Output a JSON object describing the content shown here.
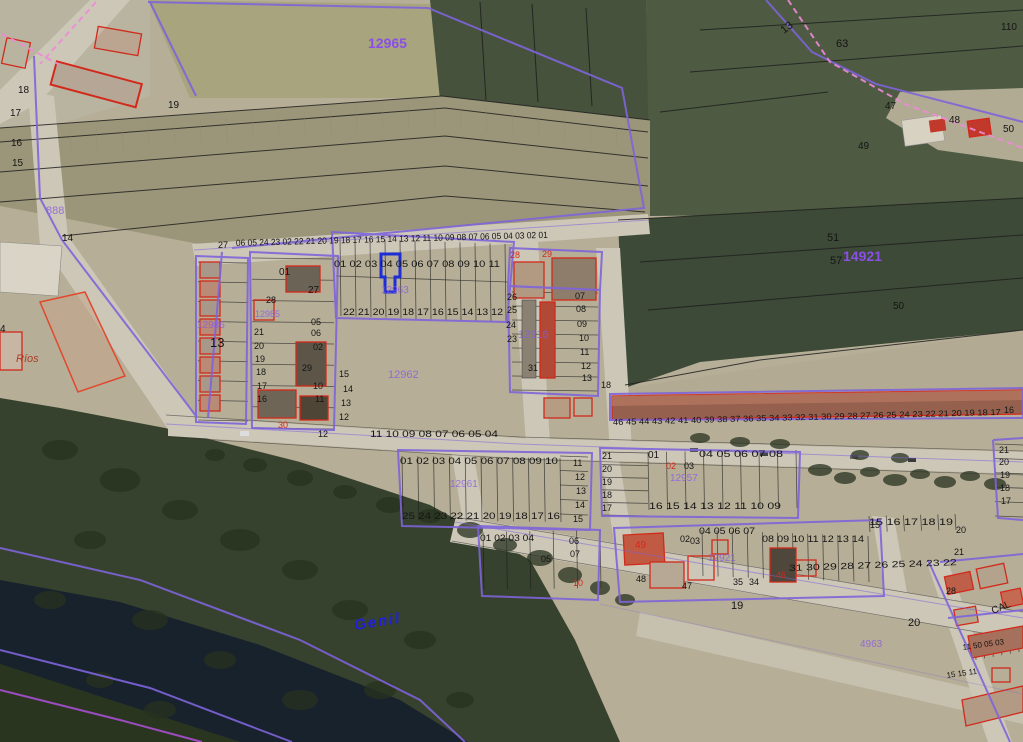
{
  "map": {
    "type": "cadastral-aerial-view",
    "selected_parcel": {
      "number": "04"
    },
    "colors": {
      "black": "#151515",
      "zone": "#8a4fe8",
      "zoneFaint": "#8a5ce0",
      "red": "#d3291b",
      "river": "#2020dd",
      "darkred": "#b33a28",
      "boundary": "#7e64da",
      "selected": "#1d2ed6",
      "dashed": "#ef8ad9"
    },
    "labels": [
      {
        "t": "12965",
        "x": 368,
        "y": 48,
        "s": 14,
        "c": "zone",
        "b": true,
        "n": "zone-code-label"
      },
      {
        "t": "14921",
        "x": 843,
        "y": 261,
        "s": 14,
        "c": "zone",
        "b": true,
        "n": "zone-code-label"
      },
      {
        "t": "12963",
        "x": 381,
        "y": 293,
        "s": 10,
        "c": "zoneFaint",
        "n": "zone-code-label"
      },
      {
        "t": "12962",
        "x": 388,
        "y": 378,
        "s": 11,
        "c": "zoneFaint",
        "n": "zone-code-label"
      },
      {
        "t": "12916",
        "x": 518,
        "y": 338,
        "s": 11,
        "c": "zoneFaint",
        "n": "zone-code-label"
      },
      {
        "t": "12986",
        "x": 197,
        "y": 328,
        "s": 10,
        "c": "zoneFaint",
        "n": "zone-code-label"
      },
      {
        "t": "12985",
        "x": 255,
        "y": 317,
        "s": 9,
        "c": "zoneFaint",
        "n": "zone-code-label"
      },
      {
        "t": "12961",
        "x": 450,
        "y": 487,
        "s": 10,
        "c": "zoneFaint",
        "n": "zone-code-label"
      },
      {
        "t": "12957",
        "x": 670,
        "y": 481,
        "s": 10,
        "c": "zoneFaint",
        "n": "zone-code-label"
      },
      {
        "t": "12921",
        "x": 708,
        "y": 561,
        "s": 10,
        "c": "zoneFaint",
        "n": "zone-code-label"
      },
      {
        "t": "888",
        "x": 46,
        "y": 214,
        "s": 11,
        "c": "zoneFaint",
        "n": "zone-code-label"
      },
      {
        "t": "4963",
        "x": 860,
        "y": 647,
        "s": 10,
        "c": "zoneFaint",
        "n": "zone-code-label"
      },
      {
        "t": "Genil",
        "x": 355,
        "y": 630,
        "s": 15,
        "c": "river",
        "b": true,
        "i": true,
        "r": -9,
        "n": "river-name-label"
      },
      {
        "t": "CAL",
        "x": 993,
        "y": 614,
        "s": 10,
        "r": -22,
        "n": "street-name-label"
      },
      {
        "t": "Ríos",
        "x": 16,
        "y": 362,
        "s": 11,
        "c": "darkred",
        "i": true,
        "n": "place-name-label"
      },
      {
        "t": "18",
        "x": 18,
        "y": 93,
        "s": 10
      },
      {
        "t": "19",
        "x": 168,
        "y": 108,
        "s": 10
      },
      {
        "t": "17",
        "x": 10,
        "y": 116,
        "s": 10
      },
      {
        "t": "16",
        "x": 11,
        "y": 146,
        "s": 10
      },
      {
        "t": "15",
        "x": 12,
        "y": 166,
        "s": 10
      },
      {
        "t": "14",
        "x": 62,
        "y": 241,
        "s": 10
      },
      {
        "t": "4",
        "x": 0,
        "y": 332,
        "s": 10
      },
      {
        "t": "13",
        "x": 784,
        "y": 34,
        "s": 11,
        "r": -38
      },
      {
        "t": "63",
        "x": 836,
        "y": 47,
        "s": 11
      },
      {
        "t": "110",
        "x": 1001,
        "y": 30,
        "s": 10
      },
      {
        "t": "47",
        "x": 885,
        "y": 109,
        "s": 10
      },
      {
        "t": "49",
        "x": 858,
        "y": 149,
        "s": 10
      },
      {
        "t": "48",
        "x": 949,
        "y": 123,
        "s": 10
      },
      {
        "t": "50",
        "x": 1003,
        "y": 132,
        "s": 10
      },
      {
        "t": "51",
        "x": 827,
        "y": 241,
        "s": 11
      },
      {
        "t": "57",
        "x": 830,
        "y": 264,
        "s": 11
      },
      {
        "t": "50",
        "x": 893,
        "y": 309,
        "s": 10
      },
      {
        "t": "27",
        "x": 218,
        "y": 248
      },
      {
        "t": "01",
        "x": 279,
        "y": 275,
        "s": 10
      },
      {
        "t": "27",
        "x": 308,
        "y": 293,
        "s": 10
      },
      {
        "t": "28",
        "x": 266,
        "y": 303
      },
      {
        "t": "13",
        "x": 210,
        "y": 347,
        "s": 13
      },
      {
        "t": "05",
        "x": 311,
        "y": 325
      },
      {
        "t": "06",
        "x": 311,
        "y": 336
      },
      {
        "t": "02",
        "x": 313,
        "y": 350
      },
      {
        "t": "21",
        "x": 254,
        "y": 335
      },
      {
        "t": "20",
        "x": 254,
        "y": 349
      },
      {
        "t": "19",
        "x": 255,
        "y": 362
      },
      {
        "t": "18",
        "x": 256,
        "y": 375
      },
      {
        "t": "17",
        "x": 257,
        "y": 389
      },
      {
        "t": "16",
        "x": 257,
        "y": 402
      },
      {
        "t": "29",
        "x": 302,
        "y": 371
      },
      {
        "t": "10",
        "x": 313,
        "y": 389
      },
      {
        "t": "11",
        "x": 315,
        "y": 402
      },
      {
        "t": "30",
        "x": 278,
        "y": 428,
        "c": "red"
      },
      {
        "t": "12",
        "x": 318,
        "y": 437
      },
      {
        "t": "15",
        "x": 339,
        "y": 377
      },
      {
        "t": "14",
        "x": 343,
        "y": 392
      },
      {
        "t": "13",
        "x": 341,
        "y": 406
      },
      {
        "t": "12",
        "x": 339,
        "y": 420
      },
      {
        "t": "28",
        "x": 510,
        "y": 258,
        "c": "red"
      },
      {
        "t": "29",
        "x": 542,
        "y": 257,
        "c": "red"
      },
      {
        "t": "26",
        "x": 507,
        "y": 300
      },
      {
        "t": "25",
        "x": 507,
        "y": 313
      },
      {
        "t": "24",
        "x": 506,
        "y": 328
      },
      {
        "t": "23",
        "x": 507,
        "y": 342
      },
      {
        "t": "07",
        "x": 575,
        "y": 299
      },
      {
        "t": "08",
        "x": 576,
        "y": 312
      },
      {
        "t": "09",
        "x": 577,
        "y": 327
      },
      {
        "t": "10",
        "x": 579,
        "y": 341
      },
      {
        "t": "11",
        "x": 580,
        "y": 355
      },
      {
        "t": "12",
        "x": 581,
        "y": 369
      },
      {
        "t": "13",
        "x": 582,
        "y": 381
      },
      {
        "t": "31",
        "x": 528,
        "y": 371
      },
      {
        "t": "18",
        "x": 601,
        "y": 388
      },
      {
        "t": "16",
        "x": 1004,
        "y": 413
      },
      {
        "t": "21",
        "x": 999,
        "y": 453
      },
      {
        "t": "20",
        "x": 999,
        "y": 465
      },
      {
        "t": "19",
        "x": 1000,
        "y": 478
      },
      {
        "t": "18",
        "x": 1000,
        "y": 491
      },
      {
        "t": "17",
        "x": 1001,
        "y": 504
      },
      {
        "t": "11",
        "x": 573,
        "y": 466
      },
      {
        "t": "12",
        "x": 575,
        "y": 480
      },
      {
        "t": "13",
        "x": 576,
        "y": 494
      },
      {
        "t": "14",
        "x": 575,
        "y": 508
      },
      {
        "t": "15",
        "x": 573,
        "y": 522
      },
      {
        "t": "21",
        "x": 602,
        "y": 459
      },
      {
        "t": "20",
        "x": 602,
        "y": 472
      },
      {
        "t": "19",
        "x": 602,
        "y": 485
      },
      {
        "t": "18",
        "x": 602,
        "y": 498
      },
      {
        "t": "17",
        "x": 602,
        "y": 511
      },
      {
        "t": "01",
        "x": 648,
        "y": 458,
        "s": 10
      },
      {
        "t": "02",
        "x": 666,
        "y": 469,
        "c": "red"
      },
      {
        "t": "03",
        "x": 684,
        "y": 469
      },
      {
        "t": "05",
        "x": 541,
        "y": 562
      },
      {
        "t": "06",
        "x": 569,
        "y": 544
      },
      {
        "t": "07",
        "x": 570,
        "y": 557
      },
      {
        "t": "10",
        "x": 573,
        "y": 586,
        "c": "red"
      },
      {
        "t": "49",
        "x": 635,
        "y": 548,
        "s": 10,
        "c": "red"
      },
      {
        "t": "48",
        "x": 636,
        "y": 582
      },
      {
        "t": "02",
        "x": 680,
        "y": 542
      },
      {
        "t": "03",
        "x": 690,
        "y": 544
      },
      {
        "t": "15",
        "x": 870,
        "y": 528
      },
      {
        "t": "20",
        "x": 956,
        "y": 533
      },
      {
        "t": "21",
        "x": 954,
        "y": 555
      },
      {
        "t": "47",
        "x": 682,
        "y": 589
      },
      {
        "t": "35",
        "x": 733,
        "y": 585
      },
      {
        "t": "34",
        "x": 749,
        "y": 585
      },
      {
        "t": "46",
        "x": 776,
        "y": 578,
        "c": "red"
      },
      {
        "t": "19",
        "x": 731,
        "y": 609,
        "s": 11
      },
      {
        "t": "20",
        "x": 908,
        "y": 626,
        "s": 11
      },
      {
        "t": "28",
        "x": 946,
        "y": 594
      },
      {
        "t": "06 05 24 23 02 22 21 20 19 18 17 16 15 14 13 12 11 10 09 08 07 06 05 04 03 02 01",
        "x": 236,
        "y": 246,
        "l": 312,
        "r": -1.5,
        "n": "parcel-number-row"
      },
      {
        "t": "01 02 03 04 05 06 07 08 09 10 11",
        "x": 334,
        "y": 267,
        "l": 166,
        "n": "parcel-number-row"
      },
      {
        "t": "22 21 20 19 18 17 16 15 14 13 12",
        "x": 343,
        "y": 315,
        "l": 160,
        "n": "parcel-number-row"
      },
      {
        "t": "11 10 09 08 07 06 05 04",
        "x": 370,
        "y": 437,
        "l": 128,
        "n": "parcel-number-row"
      },
      {
        "t": "46 45 44 43 42 41 40 39 38 37 36 35 34 33 32 31 30 29 28 27 26 25 24 23 22 21 20 19 18 17",
        "x": 613,
        "y": 425,
        "s": 8.5,
        "l": 388,
        "r": -1.5,
        "n": "parcel-number-row"
      },
      {
        "t": "01 02 03 04 05 06 07 08 09 10",
        "x": 400,
        "y": 464,
        "l": 158,
        "n": "parcel-number-row"
      },
      {
        "t": "25 24 23 22 21 20 19 18 17 16",
        "x": 402,
        "y": 519,
        "l": 158,
        "n": "parcel-number-row"
      },
      {
        "t": "04 05 06 07 08",
        "x": 699,
        "y": 457,
        "l": 84,
        "n": "parcel-number-row"
      },
      {
        "t": "16 15 14 13 12 11 10 09",
        "x": 649,
        "y": 509,
        "l": 132,
        "n": "parcel-number-row"
      },
      {
        "t": "01 02 03 04",
        "x": 480,
        "y": 541,
        "l": 54,
        "n": "parcel-number-row"
      },
      {
        "t": "04 05 06 07",
        "x": 699,
        "y": 534,
        "l": 56,
        "n": "parcel-number-row"
      },
      {
        "t": "08 09 10 11 12 13 14",
        "x": 762,
        "y": 542,
        "l": 102,
        "n": "parcel-number-row"
      },
      {
        "t": "15 16 17 18 19",
        "x": 869,
        "y": 525,
        "l": 84,
        "n": "parcel-number-row"
      },
      {
        "t": "31 30 29 28 27 26 25 24 23 22",
        "x": 789,
        "y": 571,
        "l": 168,
        "r": -2,
        "n": "parcel-number-row"
      },
      {
        "t": "11 50 05 03",
        "x": 963,
        "y": 650,
        "s": 8,
        "r": -8,
        "n": "parcel-number-row"
      },
      {
        "t": "15 15 11",
        "x": 947,
        "y": 678,
        "s": 8,
        "r": -8,
        "n": "parcel-number-row"
      }
    ]
  }
}
